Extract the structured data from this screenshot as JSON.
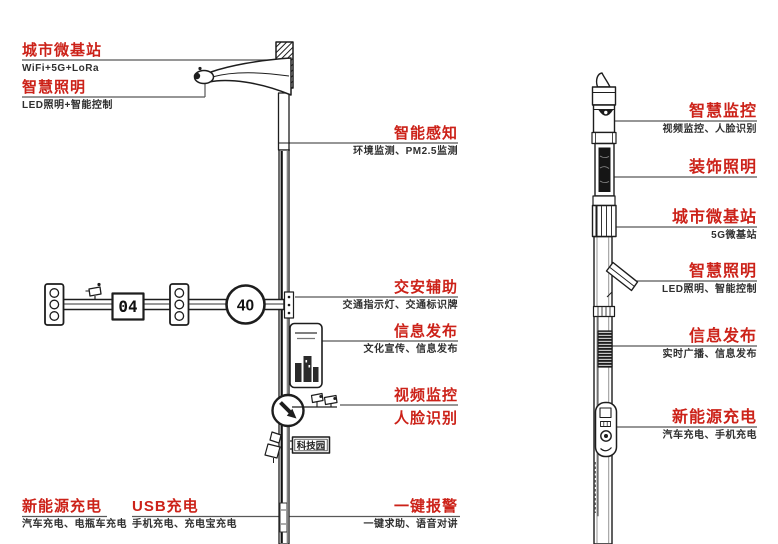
{
  "colors": {
    "accent_red": "#cc2219",
    "sub_text": "#2f2f2f",
    "leader_line": "#585858",
    "ink": "#1d1d1d"
  },
  "left_pole": {
    "callouts_left": [
      {
        "title": "城市微基站",
        "sub": "WiFi+5G+LoRa"
      },
      {
        "title": "智慧照明",
        "sub": "LED照明+智能控制"
      }
    ],
    "callouts_right": [
      {
        "title": "智能感知",
        "sub": "环境监测、PM2.5监测"
      },
      {
        "title": "交安辅助",
        "sub": "交通指示灯、交通标识牌"
      },
      {
        "title": "信息发布",
        "sub": "文化宣传、信息发布"
      },
      {
        "title": "视频监控",
        "title2": "人脸识别"
      },
      {
        "title": "一键报警",
        "sub": "一键求助、语音对讲"
      }
    ],
    "callouts_bottom": [
      {
        "title": "新能源充电",
        "sub": "汽车充电、电瓶车充电"
      },
      {
        "title": "USB充电",
        "sub": "手机充电、充电宝充电"
      }
    ],
    "signs": {
      "speed_limit": "40",
      "countdown": "04",
      "street_name": "科技园"
    }
  },
  "right_pole": {
    "callouts": [
      {
        "title": "智慧监控",
        "sub": "视频监控、人脸识别"
      },
      {
        "title": "装饰照明",
        "sub": ""
      },
      {
        "title": "城市微基站",
        "sub": "5G微基站"
      },
      {
        "title": "智慧照明",
        "sub": "LED照明、智能控制"
      },
      {
        "title": "信息发布",
        "sub": "实时广播、信息发布"
      },
      {
        "title": "新能源充电",
        "sub": "汽车充电、手机充电"
      }
    ]
  }
}
